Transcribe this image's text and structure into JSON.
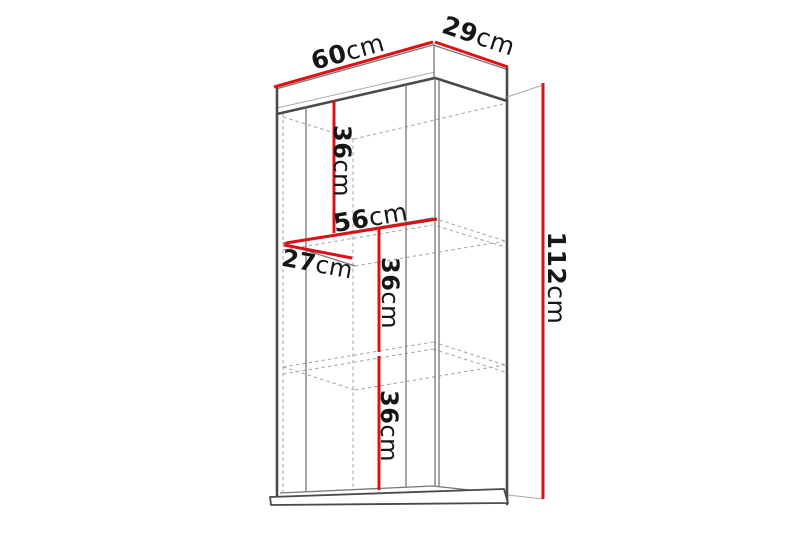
{
  "diagram": {
    "title": "Wall cabinet dimension diagram",
    "unit": "cm",
    "colors": {
      "accent": "#dd1016",
      "outline": "#4a4a4a",
      "hidden": "#a6abad",
      "text": "#161616",
      "background": "#ffffff"
    },
    "dimensions": {
      "width": {
        "num": "60",
        "unit": "cm",
        "value": 60
      },
      "depth": {
        "num": "29",
        "unit": "cm",
        "value": 29
      },
      "height": {
        "num": "112",
        "unit": "cm",
        "value": 112
      },
      "top_section": {
        "num": "36",
        "unit": "cm",
        "value": 36
      },
      "interior_width": {
        "num": "56",
        "unit": "cm",
        "value": 56
      },
      "interior_depth": {
        "num": "27",
        "unit": "cm",
        "value": 27
      },
      "middle_section": {
        "num": "36",
        "unit": "cm",
        "value": 36
      },
      "bottom_section": {
        "num": "36",
        "unit": "cm",
        "value": 36
      }
    }
  }
}
